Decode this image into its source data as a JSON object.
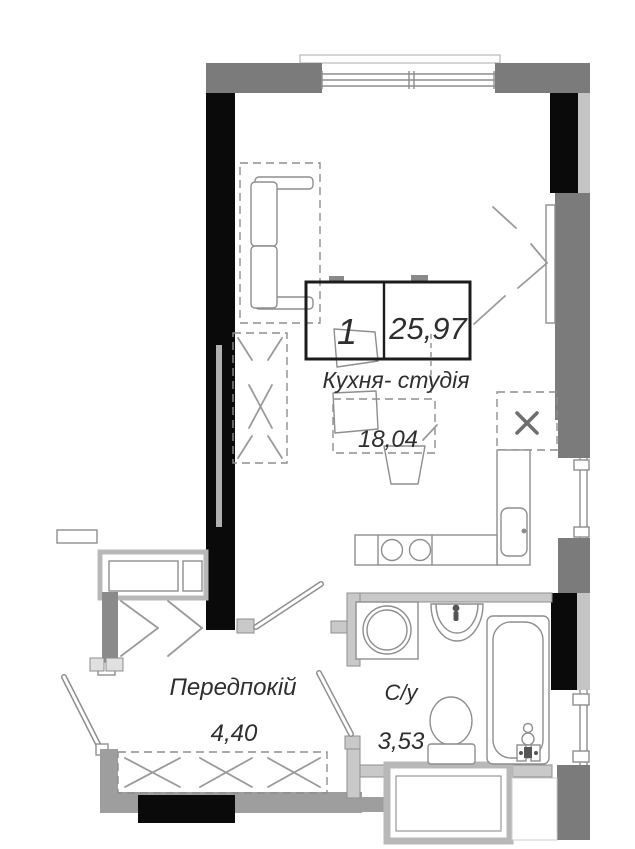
{
  "unit": {
    "number": "1",
    "total_area": "25,97"
  },
  "rooms": {
    "kitchen_studio": {
      "name": "Кухня- студія",
      "area": "18,04"
    },
    "hallway": {
      "name": "Передпокій",
      "area": "4,40"
    },
    "bathroom": {
      "name": "С/у",
      "area": "3,53"
    }
  },
  "colors": {
    "wall_dark": "#7b7b7b",
    "wall_black": "#0a0a0a",
    "wall_mid": "#9e9e9e",
    "wall_light": "#c9c9c9",
    "line": "#8e8e8e",
    "text": "#2e2e2e",
    "label_box_border": "#1c1c1c"
  }
}
